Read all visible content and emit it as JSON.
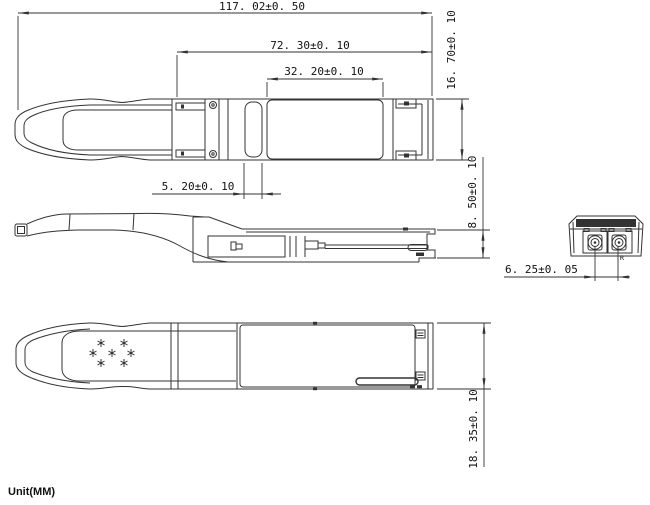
{
  "drawing": {
    "unit_label": "Unit(MM)",
    "dimensions": {
      "overall_length": "117. 02±0. 50",
      "housing_length": "72. 30±0. 10",
      "label_area_length": "32. 20±0. 10",
      "latch_slot_width": "5. 20±0. 10",
      "module_width": "16. 70±0. 10",
      "module_height": "8. 50±0. 10",
      "overall_height_with_bail": "18. 35±0. 10",
      "optical_port_pitch": "6. 25±0. 05"
    },
    "labels": {
      "receive_port": "R"
    },
    "colors": {
      "line_color": "#333333",
      "text_color": "#111111",
      "background": "#ffffff"
    }
  }
}
